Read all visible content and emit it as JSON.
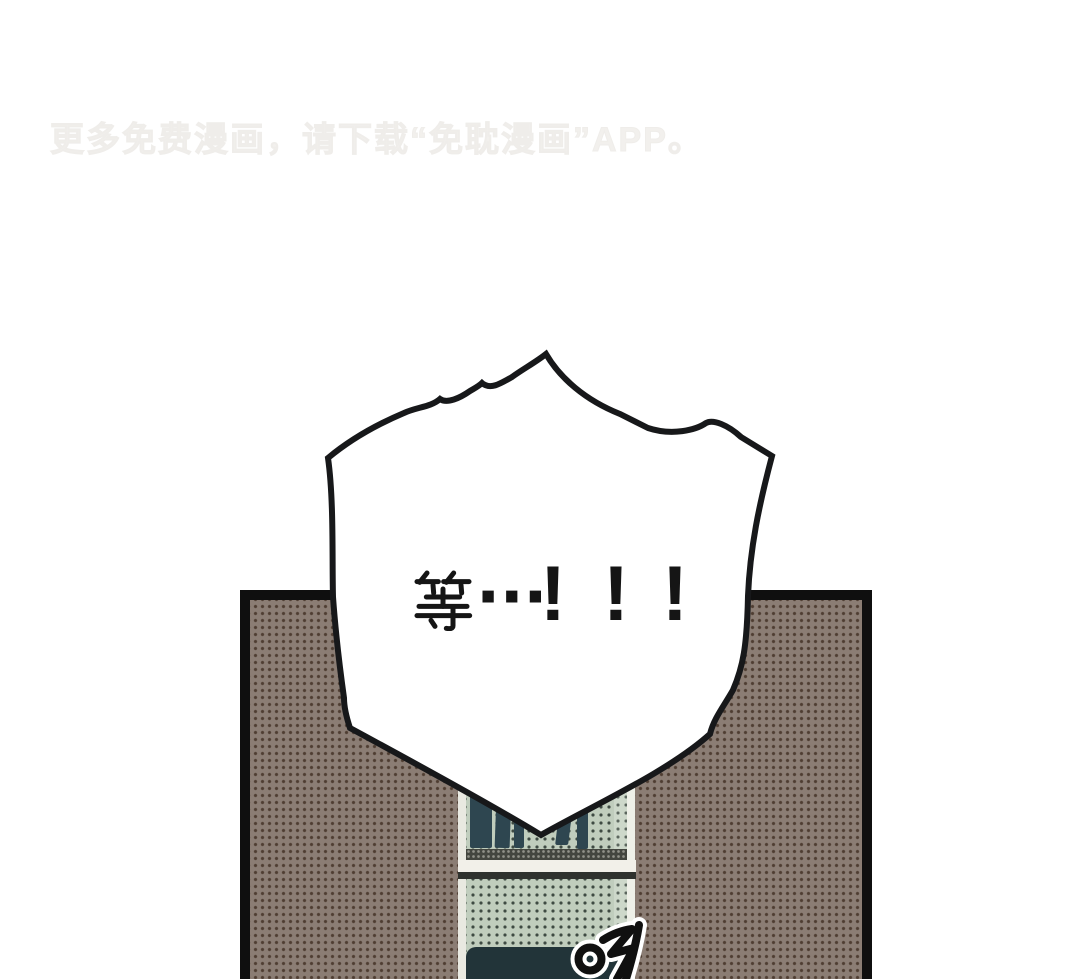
{
  "page": {
    "width": 1080,
    "height": 979,
    "background_color": "#ffffff"
  },
  "watermark": {
    "text": "更多免费漫画，请下载“免耽漫画”APP。",
    "color": "#f2f0ed"
  },
  "speech_bubble": {
    "text": "等…！！！",
    "hanzi": "等",
    "ellipsis": "···",
    "exclamations": [
      "!",
      "!",
      "!"
    ],
    "fill_color": "#ffffff",
    "outline_color": "#17181a",
    "text_color": "#151515"
  },
  "panel": {
    "border_color": "#0f0f0f",
    "background_color": "#8b7d74",
    "halftone_dot_color": "#54453c"
  },
  "bookshelf": {
    "front_color": "#c0cdbd",
    "side_color": "#cdd8ca",
    "edge_highlight_color": "#edefe6",
    "halftone_dot_color": "#2f3b33",
    "book_color": "#2e4650",
    "shelf_shadow_color": "#43463f",
    "shelf_board_color": "#f2f0e9",
    "shelf_board_edge_color": "#2f322e",
    "bottom_shadow_color": "#223439"
  },
  "sfx": {
    "text": "야",
    "ink_color": "#101010",
    "halo_color": "#ffffff"
  }
}
